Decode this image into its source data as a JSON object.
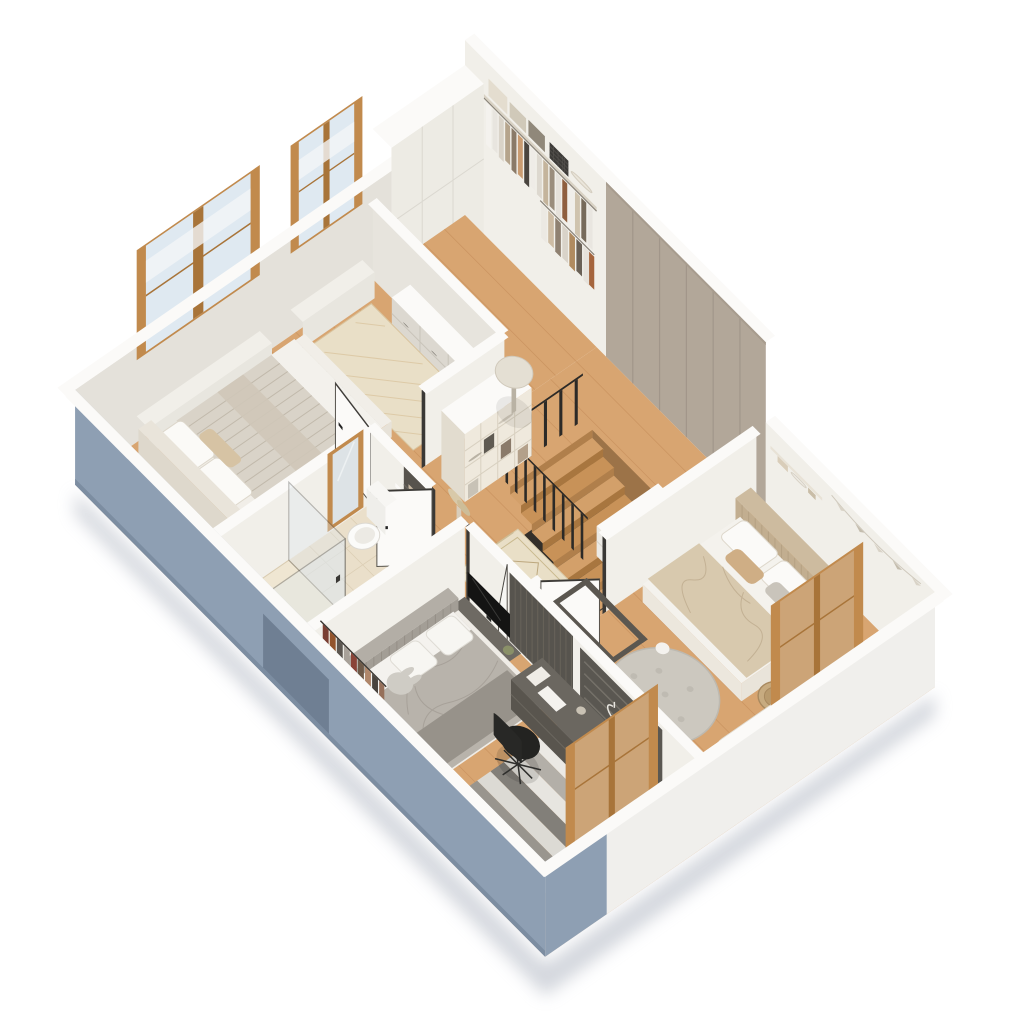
{
  "title": "Isometric 3D floor plan - upper floor cutaway",
  "palette": {
    "background": "#ffffff",
    "shadow": "#c9cdd5",
    "wood": "#d8a571",
    "woodDark": "#c08a55",
    "plank": "#bc8350",
    "tile": "#eadfca",
    "tileLine": "#d9cbb0",
    "wallFace": "#f1efe9",
    "wallFace2": "#e4e1da",
    "wallTop": "#fbfaf8",
    "taupe": "#b2a799",
    "taupeSeam": "#a1968a",
    "ext": "#8e9fb3",
    "extDark": "#7c8da1",
    "extWhite": "#f0efec",
    "frame": "#c18a4d",
    "frameDark": "#a87439",
    "glass": "#dfe9f1",
    "railing": "#2c2a27",
    "dark": "#57534d",
    "darker": "#3f3c37",
    "black": "#1b1a19",
    "textile": "#e8ddc6",
    "duvetGray": "#b8b3ab",
    "duvetBeige": "#d8c9ae",
    "rugBeige": "#e9dfc7",
    "rugGray": "#ccc8bf",
    "basket": "#c7ab80",
    "green": "#7e8a62"
  },
  "floor": {
    "label": "Upper floor",
    "rooms": {
      "closet": {
        "label": "Walk-in closet",
        "furniture": [
          "clothes-rack",
          "shelf-boxes",
          "storage-basket",
          "tall-cabinet"
        ]
      },
      "hallway": {
        "label": "Hallway landing",
        "furniture": [
          "staircase",
          "black-railing",
          "bookshelf",
          "runner-rug",
          "round-side-table",
          "pampas-vase",
          "sideboard",
          "wardrobe-wall"
        ]
      },
      "master": {
        "label": "Master bedroom",
        "furniture": [
          "double-bed",
          "herringbone-rug",
          "dresser",
          "cactus-planters",
          "wood-windows"
        ]
      },
      "bathroom": {
        "label": "Bathroom",
        "furniture": [
          "walk-in-shower",
          "toilet",
          "vanity-sink",
          "leaning-mirror",
          "storage-shelf",
          "plant"
        ]
      },
      "kids": {
        "label": "Kids bedroom",
        "furniture": [
          "upholstered-bed",
          "round-rug",
          "wicker-baskets",
          "open-wardrobe",
          "play-mat",
          "teddy-bears",
          "climbing-frame",
          "wall-shelf",
          "wood-window"
        ]
      },
      "teen": {
        "label": "Second bedroom",
        "furniture": [
          "bed",
          "striped-rug",
          "tv-console",
          "pegboard-wall",
          "desk-with-monitor",
          "office-chair",
          "open-closet",
          "wood-window"
        ]
      }
    }
  }
}
